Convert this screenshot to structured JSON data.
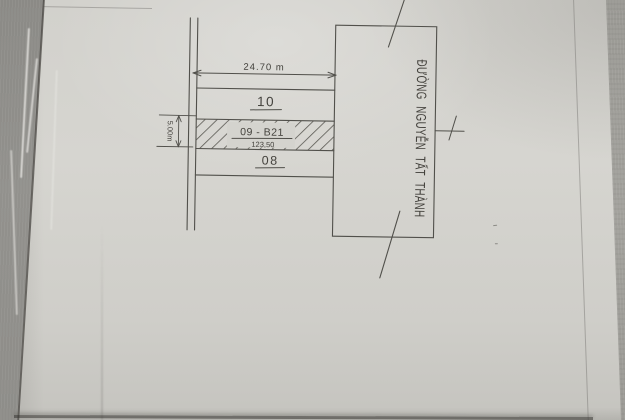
{
  "sketch": {
    "top_dimension_label": "24.70 m",
    "side_dimension_label": "5.00m",
    "plots": [
      {
        "label": "10"
      },
      {
        "label": "09 - B21",
        "area": "123,50"
      },
      {
        "label": "08"
      }
    ],
    "road_name": "ĐƯỜNG NGUYỄN TẤT THÀNH"
  },
  "colors": {
    "ink": "#51504b",
    "text_ink": "#44423d",
    "paper": "#d4d3ce",
    "backdrop_left": "#8d8c88",
    "backdrop_right": "#a09f9a"
  }
}
